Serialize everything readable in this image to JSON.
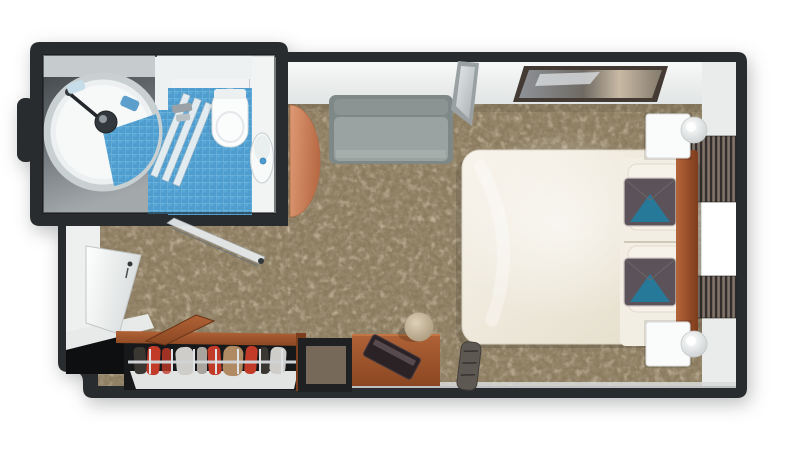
{
  "meta": {
    "kind": "3d-top-down-floorplan-render",
    "scene": "cruise-cabin-stateroom-with-bathroom",
    "background": "#ffffff"
  },
  "colors": {
    "wall_dark": "#292c2e",
    "partition_white": "#eef1f1",
    "pod_white": "#f7f9f9",
    "pod_rim": "#c9d0d2",
    "fixture_dark": "#33383c",
    "toilet_white": "#fbfcfc",
    "counter_white": "#f2f4f4",
    "glass_light": "#eef2f3",
    "tile_blue": "#4f9dce",
    "tile_line": "#83c2e4",
    "carpet_base": "#8a7a5e",
    "sofa_gray": "#9aa3a1",
    "sofa_back": "#7e8887",
    "table_salmon": "#d3906c",
    "wood_dark": "#7c3e1d",
    "bed_ivory": "#f2eee3",
    "pillow_dark": "#5b5359",
    "pillow_teal": "#27799a",
    "nightstand_white": "#fafbfb",
    "curtain_dark": "#332e2b",
    "curtain_mid": "#6b6159",
    "curtain_hl": "#8d8177",
    "window_white": "#ffffff",
    "closet_dark": "#17181a",
    "closet_deep": "#0e0f11",
    "shelf_white": "#e2e3e3",
    "rail_gray": "#cfd3d5",
    "clothes_red": "#c23a28",
    "clothes_tan": "#b08a62",
    "clothes_light": "#cfcdc9",
    "clothes_gray": "#a9a59e",
    "clothes_black": "#3a3632",
    "door_frame": "#eef0f0",
    "stool_beige": "#cfc3aa",
    "desk_item": "#2b2226",
    "gray_item": "#5e5852",
    "art_frame": "#433b33"
  },
  "bathroom": {
    "fixtures": [
      "circular-shower-pod",
      "shower-arm",
      "shower-drain-fixture",
      "glass-partition",
      "folding-glass-door",
      "blue-tile-floor",
      "toilet",
      "sink-counter",
      "sink-basin",
      "towel-light-blue",
      "towel-blue"
    ]
  },
  "bedroom": {
    "furniture": [
      "sofa",
      "round-side-table",
      "leaning-mirror",
      "wall-artwork",
      "double-bed",
      "accent-pillow-1",
      "accent-pillow-2",
      "headboard",
      "nightstand-top",
      "nightstand-bottom",
      "table-lamp-top",
      "table-lamp-bottom",
      "curtain-top",
      "curtain-bottom",
      "window",
      "entrance-door",
      "open-closet",
      "closet-door-open",
      "minibar-cubby",
      "desk",
      "desk-object",
      "stool",
      "floor-bag"
    ]
  },
  "closet": {
    "hanging_items": [
      "black",
      "red",
      "red",
      "white",
      "gray",
      "red",
      "tan",
      "red",
      "black",
      "white"
    ]
  }
}
